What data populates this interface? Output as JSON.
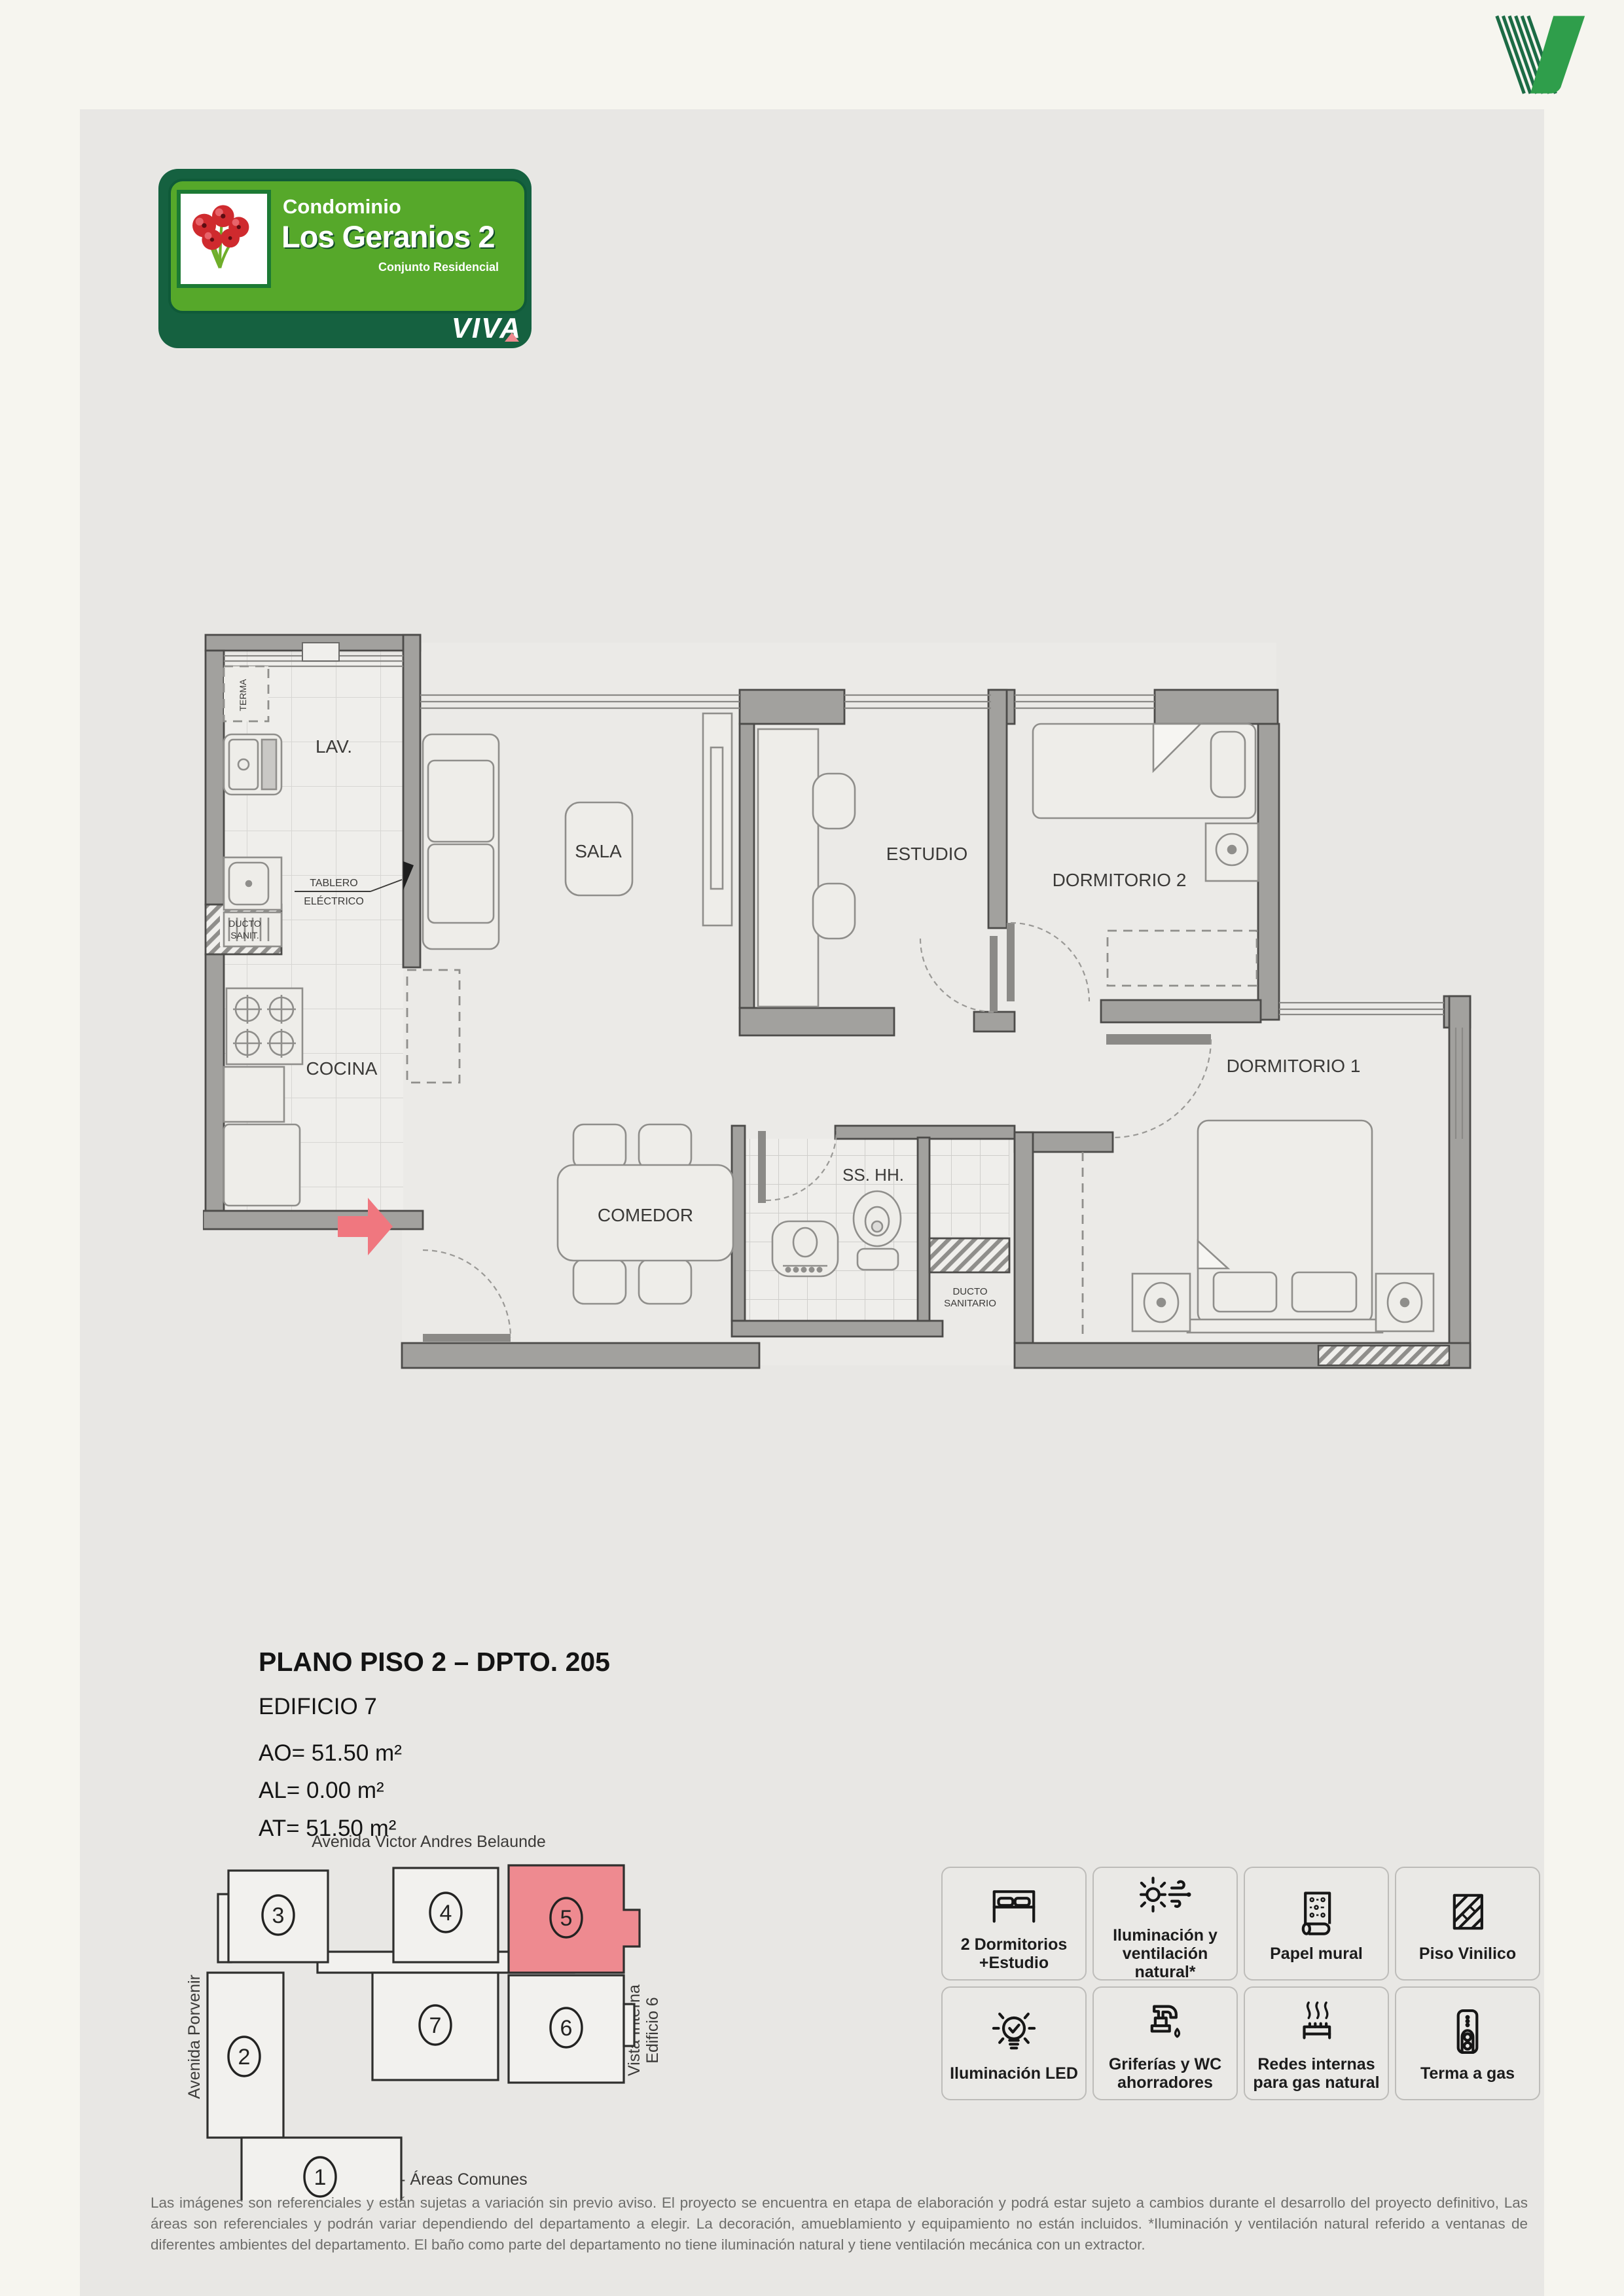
{
  "colors": {
    "accent_green_dark": "#156140",
    "accent_green_light": "#56a82a",
    "logo_green_solid": "#2f9e4b",
    "logo_green_stripe": "#1c6b45",
    "highlight_pink": "#ee8a90",
    "arrow_pink": "#f0777f",
    "wall_gray": "#a2a19e",
    "panel_gray": "#e8e7e4",
    "page_cream": "#f6f5ef"
  },
  "badge": {
    "line1": "Condominio",
    "line2": "Los Geranios 2",
    "line3": "Conjunto Residencial",
    "viva": "VIVA"
  },
  "floorplan": {
    "rooms": {
      "lav": "LAV.",
      "sala": "SALA",
      "estudio": "ESTUDIO",
      "dormitorio2": "DORMITORIO 2",
      "dormitorio1": "DORMITORIO 1",
      "cocina": "COCINA",
      "comedor": "COMEDOR",
      "bath": "SS. HH."
    },
    "small_labels": {
      "terma": "TERMA",
      "ducto_sanit_l1": "DUCTO",
      "ducto_sanit_l2": "SANIT.",
      "tablero_l1": "TABLERO",
      "tablero_l2": "ELÉCTRICO",
      "ducto_sanitario_l1": "DUCTO",
      "ducto_sanitario_l2": "SANITARIO"
    }
  },
  "title": {
    "heading": "PLANO PISO 2 – DPTO. 205",
    "building": "EDIFICIO 7",
    "area_ao": "AO= 51.50 m²",
    "area_al": "AL= 0.00 m²",
    "area_at": "AT= 51.50 m²"
  },
  "siteplan": {
    "street_top": "Avenida Victor Andres Belaunde",
    "street_left": "Avenida Porvenir",
    "right_l1": "Vista Interna",
    "right_l2": "Edificio 6",
    "bottom": "Vista Interna - Áreas Comunes",
    "highlighted_building": "5",
    "numbers": {
      "b1": "1",
      "b2": "2",
      "b3": "3",
      "b4": "4",
      "b5": "5",
      "b6": "6",
      "b7": "7"
    }
  },
  "features": {
    "cards": [
      {
        "icon": "bed-icon",
        "label": "2 Dormitorios\n+Estudio"
      },
      {
        "icon": "sun-wind-icon",
        "label": "Iluminación y\nventilación natural*"
      },
      {
        "icon": "wallpaper-icon",
        "label": "Papel mural"
      },
      {
        "icon": "vinyl-floor-icon",
        "label": "Piso Vinilico"
      },
      {
        "icon": "led-bulb-icon",
        "label": "Iluminación LED"
      },
      {
        "icon": "faucet-icon",
        "label": "Griferías y WC\nahorradores"
      },
      {
        "icon": "gas-icon",
        "label": "Redes internas\npara gas natural"
      },
      {
        "icon": "heater-icon",
        "label": "Terma a gas"
      }
    ]
  },
  "disclaimer": {
    "text": "Las imágenes son referenciales y están sujetas a variación sin previo aviso. El proyecto se encuentra en etapa de elaboración y podrá estar sujeto a cambios durante el desarrollo del proyecto definitivo, Las áreas son referenciales y podrán variar dependiendo del departamento a elegir. La decoración, amueblamiento y equipamiento no están incluidos. *Iluminación y ventilación natural referido a ventanas de diferentes ambientes del departamento. El baño como parte del departamento no tiene iluminación natural y tiene ventilación mecánica con un extractor."
  }
}
